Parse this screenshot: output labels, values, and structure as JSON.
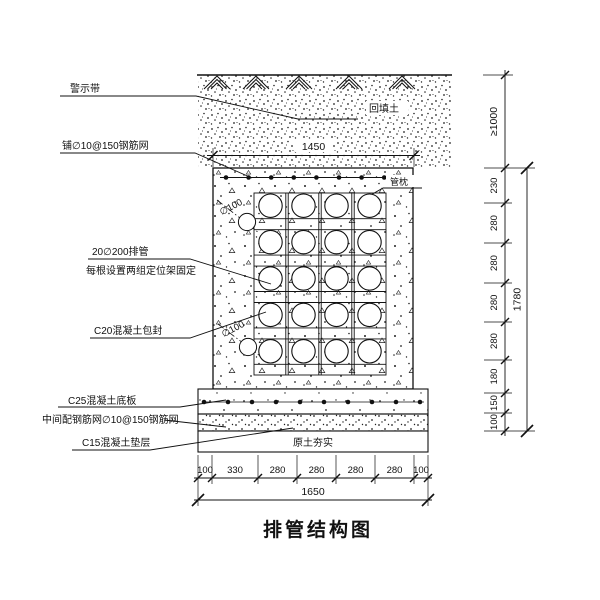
{
  "title": "排管结构图",
  "annotations": {
    "warning_tape": "警示带",
    "top_mesh": "铺∅10@150钢筋网",
    "backfill": "回填土",
    "pipe_pillow": "管枕",
    "pipe_spec": "20∅200排管",
    "pipe_fix": "每根设置两组定位架固定",
    "encase": "C20混凝土包封",
    "dia100_top": "∅100",
    "dia100_bottom": "∅100",
    "base_plate": "C25混凝土底板",
    "mid_mesh": "中间配钢筋网∅10@150钢筋网",
    "cushion": "C15混凝土垫层",
    "subsoil": "原土夯实"
  },
  "dims": {
    "top_width": "1450",
    "cover_depth": "≥1000",
    "right_segments": [
      "230",
      "280",
      "280",
      "280",
      "280",
      "180",
      "150",
      "100"
    ],
    "right_total": "1780",
    "bottom_segments": [
      "100",
      "330",
      "280",
      "280",
      "280",
      "280",
      "100"
    ],
    "bottom_total": "1650"
  },
  "colors": {
    "line": "#111111",
    "background": "#ffffff"
  }
}
